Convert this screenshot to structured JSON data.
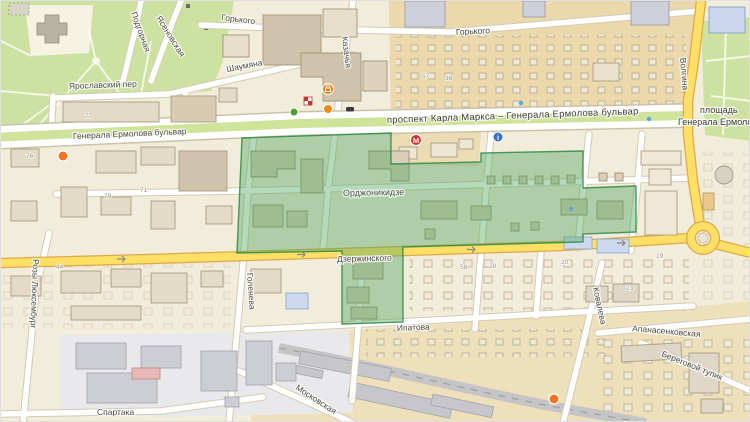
{
  "map": {
    "streets": {
      "karla_marksa": "проспект Карла Маркса – Генерала Ермолова бульвар",
      "ermolova_blvd": "Генерала Ермолова бульвар",
      "ordzhonikidze": "Орджоникидзе",
      "dzerzhinskogo": "Дзержинского",
      "ipatova": "Ипатова",
      "moskovskaya": "Московская",
      "spartaka": "Спартака",
      "apanasenkovskaya": "Апанасенковская",
      "kovaleva": "Ковалева",
      "beregovoy_tupik": "Береговой тупик",
      "goleneva": "Голенева",
      "rozy_luksemburg": "Розы Люксембург",
      "shaumyana": "Шаумяна",
      "yaroslavskiy_per": "Ярославский пер",
      "podgornaya": "Подгорная",
      "yasenovskaya": "Ясеновская",
      "gorkogo": "Горького",
      "kazachya": "Казачья",
      "volgina": "Волгина"
    },
    "square": {
      "line1": "площадь",
      "line2": "Генерала Ермоло"
    },
    "numbers": [
      "77",
      "76",
      "79",
      "71",
      "57",
      "36",
      "44",
      "58",
      "28",
      "20",
      "19",
      "23"
    ],
    "poi": {
      "store_letter": "М",
      "info_letter": "i"
    },
    "colors": {
      "selection_fill": "#4ea45e",
      "selection_border": "#2d8a45",
      "road_yellow": "#ffdf66",
      "road_casing": "#dca94b",
      "park_green": "#cde2a0",
      "base_beige": "#f2ecdb"
    }
  }
}
